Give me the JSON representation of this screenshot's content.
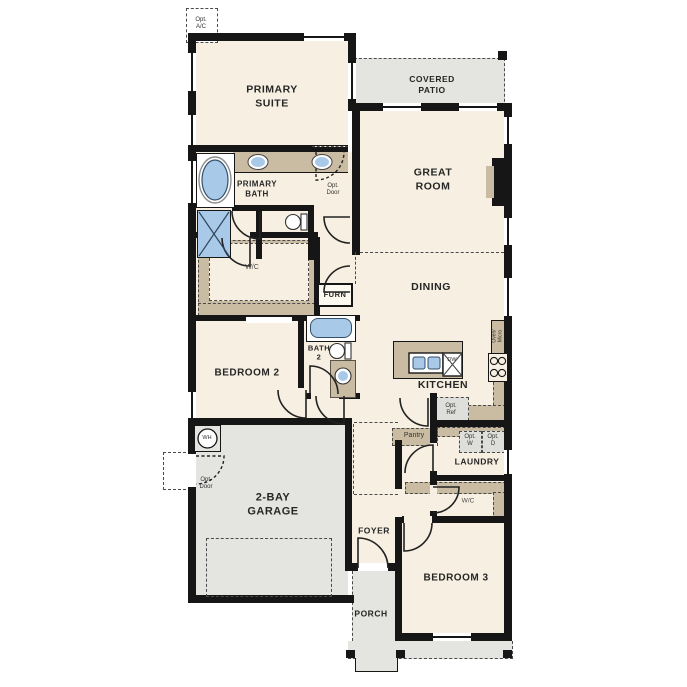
{
  "plan_name": "single-story-floor-plan",
  "labels": {
    "opt_ac": "Opt.\nA/C",
    "primary_suite": "PRIMARY\nSUITE",
    "covered_patio": "COVERED\nPATIO",
    "great_room": "GREAT\nROOM",
    "primary_bath": "PRIMARY\nBATH",
    "opt_door": "Opt.\nDoor",
    "wc": "W/C",
    "furn": "FURN",
    "dining": "DINING",
    "kitchen": "KITCHEN",
    "oven_micro": "Oven/\nMicro",
    "dw": "DW",
    "opt_ref": "Opt.\nRef",
    "bedroom_2": "BEDROOM 2",
    "bath_2": "BATH\n2",
    "wh": "WH",
    "garage": "2-BAY\nGARAGE",
    "pantry": "Pantry",
    "opt_w": "Opt.\nW",
    "opt_d": "Opt.\nD",
    "laundry": "LAUNDRY",
    "foyer": "FOYER",
    "bedroom_3": "BEDROOM 3",
    "porch": "PORCH"
  },
  "colors": {
    "room_fill": "#f7f0e2",
    "patio_fill": "#e4e4e1",
    "cabinet_tan": "#cabca2",
    "fixture_blue": "#a9c9e8",
    "wall": "#161616"
  }
}
